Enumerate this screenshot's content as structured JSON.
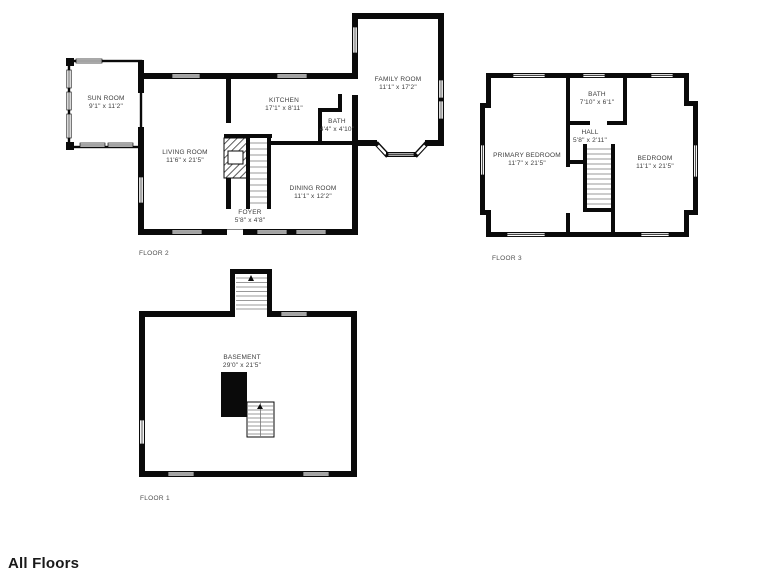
{
  "sheet": {
    "title": "All Floors"
  },
  "floors": {
    "floor2": {
      "label": "FLOOR 2",
      "rooms": {
        "sun_room": {
          "name": "SUN ROOM",
          "dims": "9'1\" x 11'2\""
        },
        "living_room": {
          "name": "LIVING ROOM",
          "dims": "11'6\" x 21'5\""
        },
        "kitchen": {
          "name": "KITCHEN",
          "dims": "17'1\" x 8'11\""
        },
        "bath": {
          "name": "BATH",
          "dims": "4'4\" x 4'10\""
        },
        "family_room": {
          "name": "FAMILY ROOM",
          "dims": "11'1\" x 17'2\""
        },
        "dining_room": {
          "name": "DINING ROOM",
          "dims": "11'1\" x 12'2\""
        },
        "foyer": {
          "name": "FOYER",
          "dims": "5'8\" x 4'8\""
        }
      }
    },
    "floor3": {
      "label": "FLOOR 3",
      "rooms": {
        "bath": {
          "name": "BATH",
          "dims": "7'10\" x 6'1\""
        },
        "hall": {
          "name": "HALL",
          "dims": "5'8\" x 2'11\""
        },
        "primary_bedroom": {
          "name": "PRIMARY BEDROOM",
          "dims": "11'7\" x 21'5\""
        },
        "bedroom": {
          "name": "BEDROOM",
          "dims": "11'1\" x 21'5\""
        }
      }
    },
    "floor1": {
      "label": "FLOOR 1",
      "rooms": {
        "basement": {
          "name": "BASEMENT",
          "dims": "29'0\" x 21'5\""
        }
      }
    }
  },
  "colors": {
    "wall": "#0a0a0a",
    "room_text": "#3d3d3d",
    "floor_text": "#4d4d4d",
    "title_text": "#191919",
    "background": "#ffffff"
  }
}
